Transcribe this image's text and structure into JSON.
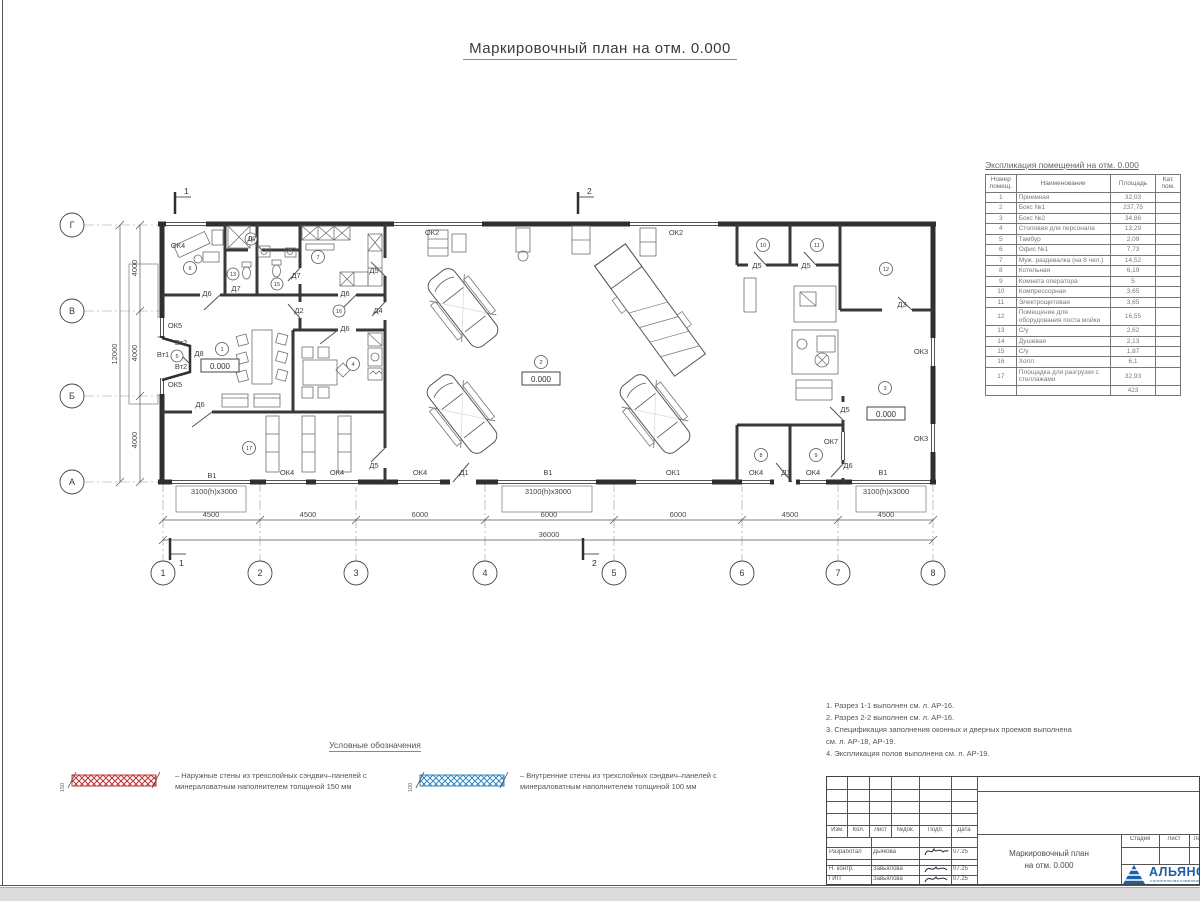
{
  "title": "Маркировочный план на отм. 0.000",
  "table": {
    "title": "Экспликация помещений на отм. 0.000",
    "headers": [
      "Номер помещ.",
      "Наименование",
      "Площадь",
      "Кат. пом."
    ],
    "rows": [
      [
        "1",
        "Приемная",
        "32,03"
      ],
      [
        "2",
        "Бокс №1",
        "237,75"
      ],
      [
        "3",
        "Бокс №2",
        "34,86"
      ],
      [
        "4",
        "Столовая для персонала",
        "13,29"
      ],
      [
        "5",
        "Тамбур",
        "2,09"
      ],
      [
        "6",
        "Офис №1",
        "7,73"
      ],
      [
        "7",
        "Муж. раздевалка (на 8 чел.)",
        "14,52"
      ],
      [
        "8",
        "Котельная",
        "6,19"
      ],
      [
        "9",
        "Комната оператора",
        "5"
      ],
      [
        "10",
        "Компрессорная",
        "3,65"
      ],
      [
        "11",
        "Электрощитовая",
        "3,65"
      ],
      [
        "12",
        "Помещение для оборудования поста мойки",
        "16,55"
      ],
      [
        "13",
        "С/у",
        "2,62"
      ],
      [
        "14",
        "Душевая",
        "2,13"
      ],
      [
        "15",
        "С/у",
        "1,87"
      ],
      [
        "16",
        "Холл",
        "6,1"
      ],
      [
        "17",
        "Площадка для разгрузки с стеллажами",
        "32,93"
      ]
    ],
    "total": "423"
  },
  "plan": {
    "axes_cols": [
      "1",
      "2",
      "3",
      "4",
      "5",
      "6",
      "7",
      "8"
    ],
    "axes_rows": [
      "Г",
      "В",
      "Б",
      "А"
    ],
    "dims_bottom": [
      "4500",
      "4500",
      "6000",
      "6000",
      "6000",
      "4500",
      "4500"
    ],
    "dim_total_bottom": "36000",
    "dims_left": [
      "4000",
      "4000",
      "4000"
    ],
    "dim_total_left": "12000",
    "section_marks": [
      "1",
      "2"
    ],
    "elevation": "0.000",
    "room_markers": [
      "1",
      "2",
      "3",
      "4",
      "5",
      "6",
      "7",
      "8",
      "9",
      "10",
      "11",
      "12",
      "13",
      "14",
      "15",
      "16",
      "17"
    ],
    "labels": [
      "ОК4",
      "Д7",
      "Д5",
      "Д6",
      "Д7",
      "Д7",
      "Д6",
      "Д2",
      "Д4",
      "Д6",
      "ОК5",
      "Вт2",
      "Вт1",
      "Д8",
      "Вт2",
      "ОК5",
      "Д6",
      "Д5",
      "ОК2",
      "ОК2",
      "Д5",
      "Д5",
      "Д3",
      "ОК3",
      "ОК3",
      "Д5",
      "ОК7",
      "Д6",
      "В1",
      "3100(h)х3000",
      "ОК4",
      "ОК4",
      "ОК4",
      "Д1",
      "В1",
      "3100(h)х3000",
      "ОК1",
      "ОК4",
      "Д1",
      "ОК4",
      "В1",
      "3100(h)х3000"
    ]
  },
  "legend": {
    "title": "Условные обозначения",
    "items": [
      {
        "dim": "150",
        "text": "– Наружные стены из трехслойных сэндвич–панелей с минераловатным наполнителем толщиной 150 мм"
      },
      {
        "dim": "100",
        "text": "– Внутренние стены из трехслойных сэндвич–панелей с минераловатным наполнителем толщиной 100 мм"
      }
    ]
  },
  "notes": [
    "1. Разрез 1-1 выполнен см. л. АР-16.",
    "2. Разрез 2-2 выполнен см. л. АР-16.",
    "3. Спецификация заполнения оконных и дверных проемов выполнена",
    "см. л. АР-18, АР-19.",
    "4. Экспликация полов выполнена см. л. АР-19."
  ],
  "titleblock": {
    "header_cols": [
      "Изм.",
      "Кол.",
      "Лист",
      "№док.",
      "Подп.",
      "Дата"
    ],
    "staff": [
      {
        "role": "Разработал",
        "name": "Дьякова",
        "date": "07.25"
      },
      {
        "role": "Н. контр.",
        "name": "Завьялова",
        "date": "07.25"
      },
      {
        "role": "ГИП",
        "name": "Завьялова",
        "date": "07.25"
      }
    ],
    "doc_title_line1": "Маркировочный план",
    "doc_title_line2": "на отм. 0.000",
    "stage_headers": [
      "Стадия",
      "Лист",
      "Лист"
    ],
    "logo_text": "АЛЬЯНС",
    "logo_sub": "строительная компания"
  }
}
